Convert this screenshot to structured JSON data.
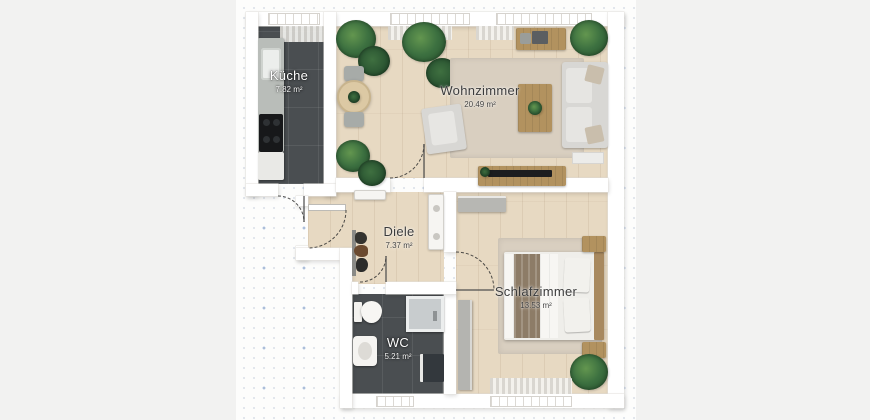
{
  "rooms": [
    {
      "id": "kueche",
      "name": "Küche",
      "area": "7.82 m²"
    },
    {
      "id": "wohnzimmer",
      "name": "Wohnzimmer",
      "area": "20.49 m²"
    },
    {
      "id": "diele",
      "name": "Diele",
      "area": "7.37 m²"
    },
    {
      "id": "schlafzimmer",
      "name": "Schlafzimmer",
      "area": "13.53 m²"
    },
    {
      "id": "wc",
      "name": "WC",
      "area": "5.21 m²"
    }
  ],
  "colors": {
    "bg": "#f2f2f1",
    "wall": "#ffffff",
    "wood": "#e7d9c2",
    "tile": "#4a4e51",
    "rug": "#d9cfc0",
    "sofa": "#d8d7d4",
    "furniture_wood": "#b2925f",
    "plant_green": "#3c7040",
    "grid_dot": "#8ca0be"
  }
}
